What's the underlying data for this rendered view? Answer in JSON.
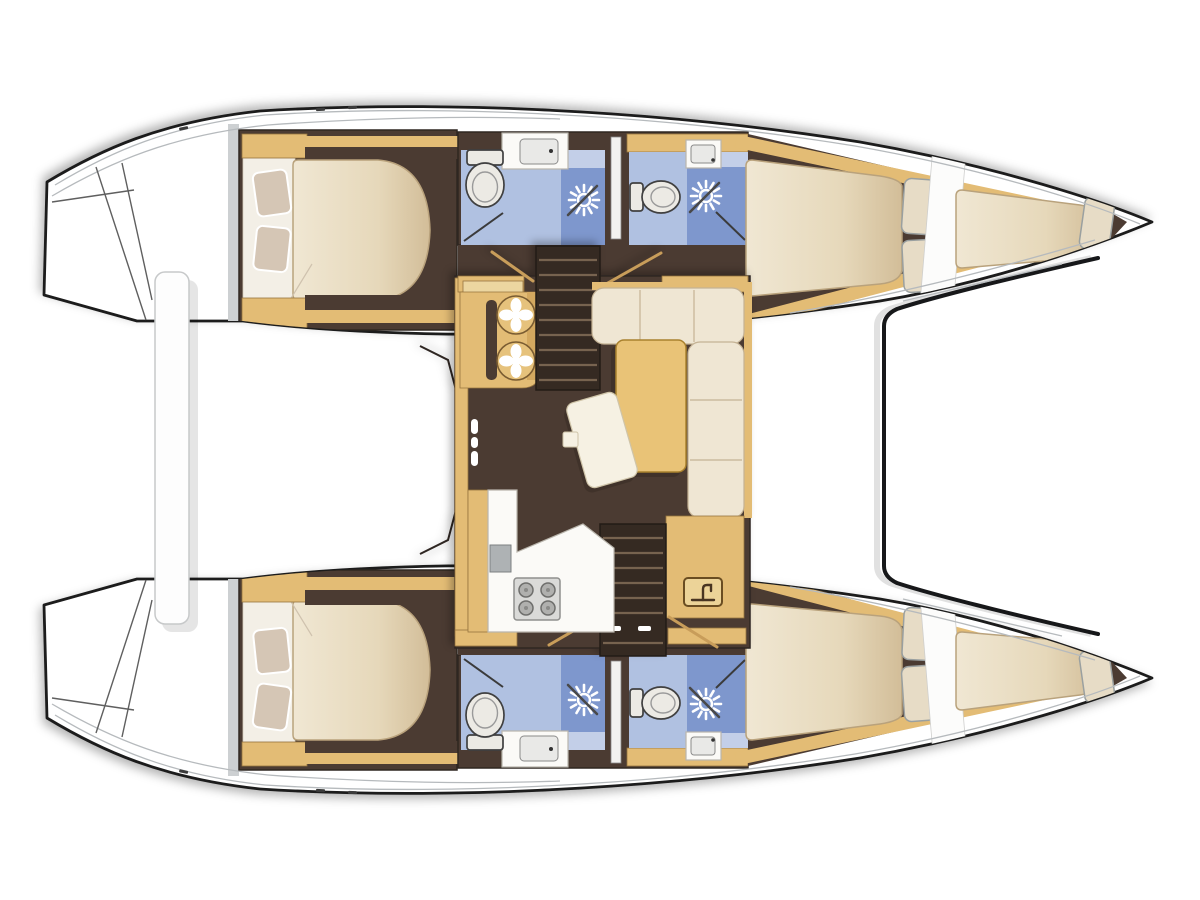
{
  "diagram": {
    "type": "boat-floor-plan",
    "subject": "catamaran interior layout, top-down deck plan",
    "orientation": {
      "bow": "right",
      "stern": "left"
    },
    "symmetry": "two mirrored hulls (top and bottom) joined by a central bridgedeck saloon",
    "hulls": [
      {
        "position": "top",
        "rooms": [
          {
            "name": "stern platform",
            "features": [
              "transom steps",
              "sugar-scoop diagonals"
            ]
          },
          {
            "name": "aft double cabin",
            "furniture": [
              "island double bed",
              "two pillows",
              "wood trim lockers"
            ]
          },
          {
            "name": "aft bathroom",
            "fixtures": [
              "toilet",
              "washbasin with counter",
              "shower with handheld shower head",
              "door swing"
            ]
          },
          {
            "name": "forward bathroom",
            "fixtures": [
              "washbasin with counter",
              "toilet",
              "shower with handheld shower head",
              "door swing"
            ]
          },
          {
            "name": "forward double cabin",
            "furniture": [
              "tapered double bed",
              "two pillows"
            ]
          },
          {
            "name": "bow berth (forepeak)",
            "furniture": [
              "single berth",
              "pillow"
            ]
          }
        ]
      },
      {
        "position": "bottom",
        "note": "mirror image of top hull with identical rooms and fixtures"
      }
    ],
    "saloon": {
      "location": "central bridgedeck",
      "features": [
        "companionway stairs to top hull",
        "companionway stairs to bottom hull",
        "galley unit with two round burners",
        "galley counter with 4-burner stove and fridge",
        "L-shaped sofa",
        "rectangular dining table",
        "tilted coffee table",
        "cabinet with faucet symbol (sink)",
        "cabinet handle dots"
      ]
    },
    "foredeck": {
      "features": [
        "curved coachroof / windscreen outline between hulls"
      ]
    },
    "aft_deck": {
      "features": [
        "white crossbar slat between sterns"
      ]
    }
  },
  "icons": [
    "toilet-icon",
    "sink-icon",
    "shower-head-icon",
    "faucet-icon",
    "burner-icon",
    "stove-4-burner-icon",
    "stairs-treads",
    "door-swing-line",
    "pillow",
    "cleat-tick"
  ],
  "colors": {
    "bg": "#ffffff",
    "outline": "#1b1b1b",
    "deck_line": "#b6babd",
    "floor": "#4b3b31",
    "floor_dark": "#352a22",
    "wood": "#e3bc74",
    "wood_dark": "#96743f",
    "wood_light": "#ecd6a0",
    "cream": "#efe6d3",
    "cream_deep": "#d6c2a0",
    "pillow": "#d5c6b5",
    "white_furniture": "#fbfaf7",
    "gray_fixture": "#aeb2b4",
    "bath_light": "#b0c1e1",
    "bath_mid": "#c3cfe8",
    "bath_deep": "#7e97cd",
    "stove": "#dadad8",
    "burner": "#b0b0ae",
    "tread": "#77634f",
    "table_yellow": "#e9c377",
    "table_edge": "#a9812e"
  }
}
